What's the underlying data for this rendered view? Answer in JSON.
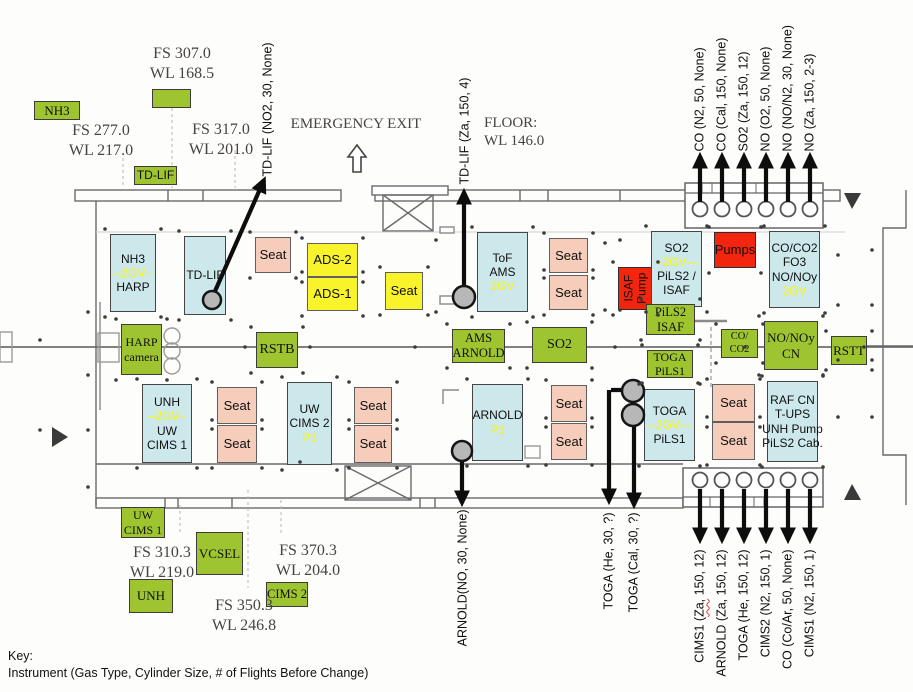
{
  "canvas": {
    "w": 913,
    "h": 692
  },
  "palette": {
    "green": "#9ec42f",
    "blue": "#cde8eb",
    "pink": "#f5cdba",
    "yellow": "#f8f32a",
    "red": "#f3250e",
    "highlight": "#fdf400",
    "ink": "#101010",
    "wall": "#6a6a6a"
  },
  "key": {
    "title": "Key:",
    "line": "Instrument (Gas Type, Cylinder Size, # of Flights Before Change)"
  },
  "texts": [
    {
      "name": "fs-307",
      "lines": [
        "FS 307.0",
        "WL 168.5"
      ],
      "cx": 182,
      "y": 44
    },
    {
      "name": "fs-277",
      "lines": [
        "FS 277.0",
        "WL 217.0"
      ],
      "cx": 101,
      "y": 121
    },
    {
      "name": "fs-317",
      "lines": [
        "FS 317.0",
        "WL 201.0"
      ],
      "cx": 221,
      "y": 120
    },
    {
      "name": "emergency-exit-text",
      "lines": [
        "EMERGENCY EXIT"
      ],
      "cx": 356,
      "y": 115,
      "fs": 15
    },
    {
      "name": "floor-text",
      "lines": [
        "FLOOR:",
        "WL 146.0"
      ],
      "x": 484,
      "y": 114,
      "fs": 15
    },
    {
      "name": "fs-310",
      "lines": [
        "FS 310.3",
        "WL 219.0"
      ],
      "cx": 162,
      "y": 543
    },
    {
      "name": "fs-370",
      "lines": [
        "FS 370.3",
        "WL 204.0"
      ],
      "cx": 308,
      "y": 541
    },
    {
      "name": "fs-350",
      "lines": [
        "FS 350.3",
        "WL 246.8"
      ],
      "cx": 244,
      "y": 596
    }
  ],
  "boxes": [
    {
      "name": "nh3-harp-rack",
      "type": "blue",
      "x": 110,
      "y": 234,
      "w": 46,
      "h": 78,
      "lines": [
        "NH3",
        {
          "t": "--2GV--",
          "hl": true
        },
        "HARP"
      ]
    },
    {
      "name": "td-lif-rack",
      "type": "blue",
      "x": 184,
      "y": 236,
      "w": 42,
      "h": 79,
      "lines": [
        "TD-LIF"
      ]
    },
    {
      "name": "seat",
      "type": "pink",
      "cls": "seat",
      "x": 255,
      "y": 237,
      "w": 36,
      "h": 36,
      "lines": [
        "Seat"
      ]
    },
    {
      "name": "ads-2",
      "type": "yellow",
      "x": 307,
      "y": 243,
      "w": 51,
      "h": 34,
      "fs": 13,
      "lines": [
        "ADS-2"
      ]
    },
    {
      "name": "ads-1",
      "type": "yellow",
      "x": 307,
      "y": 277,
      "w": 51,
      "h": 34,
      "fs": 13,
      "lines": [
        "ADS-1"
      ]
    },
    {
      "name": "seat",
      "type": "yellow",
      "cls": "seat",
      "x": 385,
      "y": 272,
      "w": 38,
      "h": 38,
      "lines": [
        "Seat"
      ]
    },
    {
      "name": "tof-ams-rack",
      "type": "blue",
      "x": 477,
      "y": 232,
      "w": 51,
      "h": 80,
      "lines": [
        "ToF",
        "AMS",
        {
          "t": "2GV",
          "hl": true
        }
      ]
    },
    {
      "name": "seat",
      "type": "pink",
      "cls": "seat",
      "x": 549,
      "y": 238,
      "w": 39,
      "h": 35,
      "lines": [
        "Seat"
      ]
    },
    {
      "name": "seat",
      "type": "pink",
      "cls": "seat",
      "x": 549,
      "y": 275,
      "w": 39,
      "h": 35,
      "lines": [
        "Seat"
      ]
    },
    {
      "name": "isaf-pump",
      "type": "red",
      "rot": true,
      "x": 618,
      "y": 267,
      "w": 35,
      "h": 43,
      "lines": [
        "ISAF",
        "Pump"
      ]
    },
    {
      "name": "so2-pils2-isaf-rack",
      "type": "blue",
      "x": 651,
      "y": 231,
      "w": 51,
      "h": 76,
      "lines": [
        "SO2",
        {
          "t": "--2GV—",
          "hl": true
        },
        "PiLS2 /",
        "ISAF"
      ]
    },
    {
      "name": "pumps",
      "type": "red",
      "x": 714,
      "y": 232,
      "w": 42,
      "h": 36,
      "fs": 13,
      "lines": [
        "Pumps"
      ]
    },
    {
      "name": "co-co2-fo3-rack",
      "type": "blue",
      "x": 769,
      "y": 231,
      "w": 51,
      "h": 77,
      "lines": [
        "CO/CO2",
        "FO3",
        "NO/NOy",
        {
          "t": "2GV",
          "hl": true
        }
      ]
    },
    {
      "name": "pils2-isaf",
      "type": "green",
      "serif": true,
      "x": 646,
      "y": 304,
      "w": 49,
      "h": 31,
      "fs": 12.5,
      "lines": [
        "PiLS2",
        "ISAF"
      ]
    },
    {
      "name": "harp-camera",
      "type": "green",
      "serif": true,
      "x": 121,
      "y": 324,
      "w": 41,
      "h": 51,
      "fs": 12,
      "lines": [
        "HARP",
        "camera"
      ]
    },
    {
      "name": "rstb",
      "type": "green",
      "serif": true,
      "x": 256,
      "y": 332,
      "w": 42,
      "h": 36,
      "fs": 14,
      "lines": [
        "RSTB"
      ]
    },
    {
      "name": "ams-arnold",
      "type": "green",
      "serif": true,
      "x": 452,
      "y": 329,
      "w": 53,
      "h": 34,
      "fs": 12.5,
      "lines": [
        "AMS",
        "ARNOLD"
      ]
    },
    {
      "name": "so2-mid",
      "type": "green",
      "serif": true,
      "x": 532,
      "y": 327,
      "w": 55,
      "h": 36,
      "fs": 14,
      "lines": [
        "SO2"
      ]
    },
    {
      "name": "toga-pils1",
      "type": "green",
      "serif": true,
      "x": 647,
      "y": 350,
      "w": 46,
      "h": 28,
      "fs": 12,
      "lines": [
        "TOGA",
        "PiLS1"
      ]
    },
    {
      "name": "co-co2-small",
      "type": "green",
      "serif": true,
      "x": 721,
      "y": 329,
      "w": 37,
      "h": 29,
      "fs": 10.5,
      "lines": [
        "CO/",
        "CO2"
      ]
    },
    {
      "name": "no-noy-cn",
      "type": "green",
      "serif": true,
      "x": 764,
      "y": 321,
      "w": 54,
      "h": 49,
      "fs": 13,
      "lines": [
        "NO/NOy",
        "CN"
      ]
    },
    {
      "name": "rstt",
      "type": "green",
      "serif": true,
      "x": 831,
      "y": 336,
      "w": 36,
      "h": 29,
      "fs": 13,
      "lines": [
        "RSTT"
      ]
    },
    {
      "name": "unh-uw-cims1-rack",
      "type": "blue",
      "x": 142,
      "y": 384,
      "w": 50,
      "h": 79,
      "lines": [
        "UNH",
        {
          "t": "--2GV--",
          "hl": true
        },
        "UW",
        "CIMS 1"
      ]
    },
    {
      "name": "seat",
      "type": "pink",
      "cls": "seat",
      "x": 217,
      "y": 387,
      "w": 40,
      "h": 37,
      "lines": [
        "Seat"
      ]
    },
    {
      "name": "seat",
      "type": "pink",
      "cls": "seat",
      "x": 217,
      "y": 425,
      "w": 40,
      "h": 38,
      "lines": [
        "Seat"
      ]
    },
    {
      "name": "uw-cims2-rack",
      "type": "blue",
      "x": 287,
      "y": 382,
      "w": 45,
      "h": 83,
      "lines": [
        "UW",
        "CIMS 2",
        {
          "t": "P3",
          "hl": true
        }
      ]
    },
    {
      "name": "seat",
      "type": "pink",
      "cls": "seat",
      "x": 354,
      "y": 387,
      "w": 38,
      "h": 37,
      "lines": [
        "Seat"
      ]
    },
    {
      "name": "seat",
      "type": "pink",
      "cls": "seat",
      "x": 354,
      "y": 425,
      "w": 38,
      "h": 38,
      "lines": [
        "Seat"
      ]
    },
    {
      "name": "arnold-rack",
      "type": "blue",
      "x": 472,
      "y": 384,
      "w": 51,
      "h": 77,
      "lines": [
        "ARNOLD",
        {
          "t": "P3",
          "hl": true
        }
      ]
    },
    {
      "name": "seat",
      "type": "pink",
      "cls": "seat",
      "x": 551,
      "y": 385,
      "w": 36,
      "h": 37,
      "lines": [
        "Seat"
      ]
    },
    {
      "name": "seat",
      "type": "pink",
      "cls": "seat",
      "x": 551,
      "y": 423,
      "w": 36,
      "h": 37,
      "lines": [
        "Seat"
      ]
    },
    {
      "name": "toga-rack",
      "type": "blue",
      "x": 644,
      "y": 389,
      "w": 51,
      "h": 72,
      "lines": [
        "TOGA",
        {
          "t": "--2GV---",
          "hl": true
        },
        "PiLS1"
      ]
    },
    {
      "name": "seat",
      "type": "pink",
      "cls": "seat",
      "x": 712,
      "y": 384,
      "w": 43,
      "h": 38,
      "lines": [
        "Seat"
      ]
    },
    {
      "name": "seat",
      "type": "pink",
      "cls": "seat",
      "x": 712,
      "y": 422,
      "w": 43,
      "h": 38,
      "lines": [
        "Seat"
      ]
    },
    {
      "name": "raf-cn-rack",
      "type": "blue",
      "x": 767,
      "y": 381,
      "w": 51,
      "h": 81,
      "lines": [
        "RAF CN",
        "T-UPS",
        "UNH Pump",
        "PiLS2 Cab."
      ]
    },
    {
      "name": "green-marker",
      "type": "green",
      "x": 152,
      "y": 89,
      "w": 39,
      "h": 19,
      "lines": []
    },
    {
      "name": "nh3-green",
      "type": "green",
      "serif": true,
      "x": 34,
      "y": 101,
      "w": 46,
      "h": 19,
      "fs": 13,
      "lines": [
        "NH3"
      ]
    },
    {
      "name": "td-lif-green",
      "type": "green",
      "x": 134,
      "y": 166,
      "w": 43,
      "h": 19,
      "fs": 12,
      "lines": [
        "TD-LIF"
      ]
    },
    {
      "name": "uw-cims1-green",
      "type": "green",
      "serif": true,
      "x": 121,
      "y": 507,
      "w": 44,
      "h": 31,
      "fs": 12,
      "lines": [
        "UW",
        "CIMS 1"
      ]
    },
    {
      "name": "vcsel-green",
      "type": "green",
      "serif": true,
      "x": 196,
      "y": 532,
      "w": 47,
      "h": 43,
      "fs": 13,
      "lines": [
        "VCSEL"
      ]
    },
    {
      "name": "unh-green",
      "type": "green",
      "serif": true,
      "x": 129,
      "y": 579,
      "w": 44,
      "h": 34,
      "fs": 13,
      "lines": [
        "UNH"
      ]
    },
    {
      "name": "cims2-green",
      "type": "green",
      "serif": true,
      "x": 266,
      "y": 582,
      "w": 42,
      "h": 25,
      "fs": 12.5,
      "lines": [
        "CIMS 2"
      ]
    }
  ],
  "gray_circles": [
    [
      212,
      300,
      9
    ],
    [
      464,
      297,
      11
    ],
    [
      462,
      451,
      10
    ],
    [
      633,
      391,
      11
    ],
    [
      633,
      415,
      11
    ]
  ],
  "racks": {
    "top": {
      "x": 685,
      "y": 183,
      "w": 138,
      "h": 45,
      "strip": 10,
      "cy": 209,
      "cx": [
        700,
        722,
        744,
        766,
        788,
        810
      ]
    },
    "bottom": {
      "x": 683,
      "y": 468,
      "w": 140,
      "h": 39,
      "strip": 10,
      "cy": 480,
      "cx": [
        700,
        722,
        744,
        766,
        788,
        810
      ]
    }
  },
  "arrows": [
    {
      "x1": 212,
      "y1": 298,
      "x2": 264,
      "y2": 180
    },
    {
      "x1": 464,
      "y1": 291,
      "x2": 464,
      "y2": 192
    },
    {
      "x1": 462,
      "y1": 456,
      "x2": 462,
      "y2": 503
    },
    {
      "x1": 630,
      "y1": 390,
      "x2": 611,
      "y2": 390,
      "head": false
    },
    {
      "x1": 609,
      "y1": 390,
      "x2": 609,
      "y2": 501
    },
    {
      "x1": 634,
      "y1": 421,
      "x2": 634,
      "y2": 505
    }
  ],
  "dots": [
    [
      40,
      340
    ],
    [
      88,
      312
    ],
    [
      88,
      375
    ],
    [
      40,
      430
    ],
    [
      88,
      430
    ],
    [
      88,
      487
    ],
    [
      245,
      347
    ],
    [
      310,
      347
    ],
    [
      415,
      347
    ],
    [
      615,
      347
    ],
    [
      745,
      347
    ],
    [
      864,
      347
    ],
    [
      838,
      255
    ],
    [
      838,
      305
    ],
    [
      838,
      360
    ],
    [
      838,
      417
    ],
    [
      872,
      250
    ],
    [
      872,
      305
    ],
    [
      872,
      360
    ],
    [
      872,
      417
    ],
    [
      620,
      240
    ],
    [
      620,
      310
    ],
    [
      436,
      240
    ],
    [
      436,
      312
    ],
    [
      605,
      243
    ],
    [
      605,
      310
    ],
    [
      300,
      462
    ]
  ],
  "cylinder_labels": {
    "top_right": [
      {
        "text": "CO (N2, 50, None)",
        "cx": 700,
        "anchor": 151
      },
      {
        "text": "CO (Cal, 150, None)",
        "cx": 722,
        "anchor": 151
      },
      {
        "text": "SO2 (Za, 150, 12)",
        "cx": 744,
        "anchor": 151
      },
      {
        "text": "NO (O2, 50, None)",
        "cx": 766,
        "anchor": 151
      },
      {
        "text": "NO (NO/N2, 30, None)",
        "cx": 788,
        "anchor": 151
      },
      {
        "text": "NO (Za, 150, 2-3)",
        "cx": 810,
        "anchor": 151
      }
    ],
    "top_center": [
      {
        "text": "TD-LIF (NO2, 30, None)",
        "cx": 268,
        "anchor": 176
      },
      {
        "text": "TD-LIF (Za, 150, 4)",
        "cx": 465,
        "anchor": 184
      }
    ],
    "bottom_center": [
      {
        "text": "ARNOLD(NO, 30, None)",
        "cx": 463,
        "anchor": 509
      },
      {
        "text": "TOGA (He, 30, ?)",
        "cx": 609,
        "anchor": 512
      },
      {
        "text": "TOGA (Cal, 30, ?)",
        "cx": 634,
        "anchor": 512
      }
    ],
    "bottom_right": [
      {
        "text": "CIMS1 (Za, 150, 12)",
        "cx": 700,
        "anchor": 549,
        "mark": "Za,"
      },
      {
        "text": "ARNOLD (Za, 150, 12)",
        "cx": 722,
        "anchor": 549
      },
      {
        "text": "TOGA (He, 150, 12)",
        "cx": 744,
        "anchor": 549
      },
      {
        "text": "CIMS2 (N2, 150, 1)",
        "cx": 766,
        "anchor": 549
      },
      {
        "text": "CO (Co/Ar, 50, None)",
        "cx": 788,
        "anchor": 549
      },
      {
        "text": "CIMS1 (N2, 150, 1)",
        "cx": 810,
        "anchor": 549
      }
    ]
  }
}
